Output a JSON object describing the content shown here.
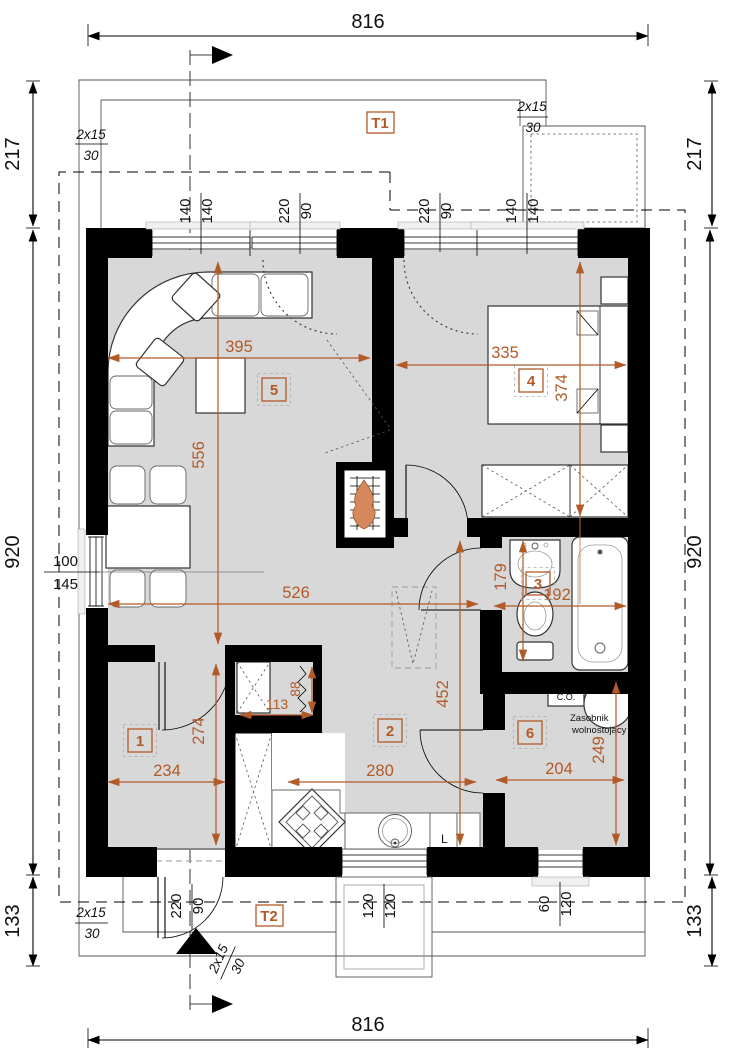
{
  "colors": {
    "accent": "#b25a28",
    "wall": "#000000",
    "floor": "#d8d8d8",
    "flame": "#d4885c"
  },
  "outer_dims": {
    "top": "816",
    "bottom": "816",
    "left": "920",
    "right": "920",
    "top_left": "217",
    "top_right": "217",
    "bottom_left": "133",
    "bottom_right": "133"
  },
  "roof_note": {
    "a": "2x15",
    "b": "30"
  },
  "terraces": {
    "t1": "T1",
    "t2": "T2"
  },
  "rooms": {
    "r1": "1",
    "r2": "2",
    "r3": "3",
    "r4": "4",
    "r5": "5",
    "r6": "6"
  },
  "dims": {
    "living_width": "395",
    "living_height": "556",
    "across_width": "526",
    "bedroom_width": "335",
    "bedroom_height": "374",
    "bath_height": "179",
    "bath_width": "192",
    "kitchen_height": "452",
    "kitchen_width": "280",
    "room1_height": "274",
    "room1_width": "234",
    "utility_width": "204",
    "utility_height": "249",
    "closet_width": "113",
    "closet_height": "88"
  },
  "openings": {
    "top_window_left": {
      "a": "140",
      "b": "140"
    },
    "top_door_left": {
      "a": "220",
      "b": "90"
    },
    "top_door_right": {
      "a": "220",
      "b": "90"
    },
    "top_window_right": {
      "a": "140",
      "b": "140"
    },
    "left_window": {
      "a": "100",
      "b": "145"
    },
    "entry_door": {
      "a": "220",
      "b": "90"
    },
    "bottom_window_mid": {
      "a": "120",
      "b": "120"
    },
    "bottom_window_right": {
      "a": "60",
      "b": "120"
    }
  },
  "equipment": {
    "boiler_line1": "kocioł",
    "boiler_line2": "C.O.",
    "tank_line1": "Zasobnik",
    "tank_line2": "wolnostojący",
    "fridge_label": "L"
  }
}
